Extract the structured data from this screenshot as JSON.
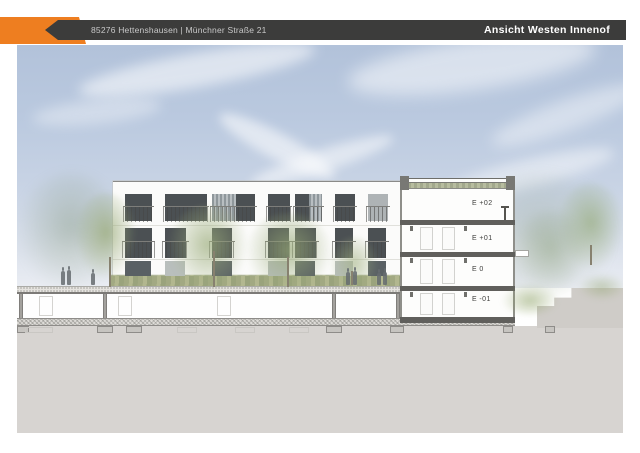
{
  "header": {
    "address": "85276 Hettenshausen | Münchner Straße 21",
    "title": "Ansicht Westen Innenof"
  },
  "colors": {
    "accent_orange": "#ee7e20",
    "header_bar": "#3c3c3b",
    "sky_top": "#b2c2da",
    "earth_gray": "#d7d4d1",
    "facade_white": "#fbfbfa",
    "window_dark": "#4b5053",
    "vegetation_green": "#9aab79"
  },
  "drawing": {
    "type": "architectural elevation / section",
    "section_floors": [
      {
        "label": "E +02"
      },
      {
        "label": "E +01"
      },
      {
        "label": "E 0"
      },
      {
        "label": "E -01"
      }
    ]
  }
}
